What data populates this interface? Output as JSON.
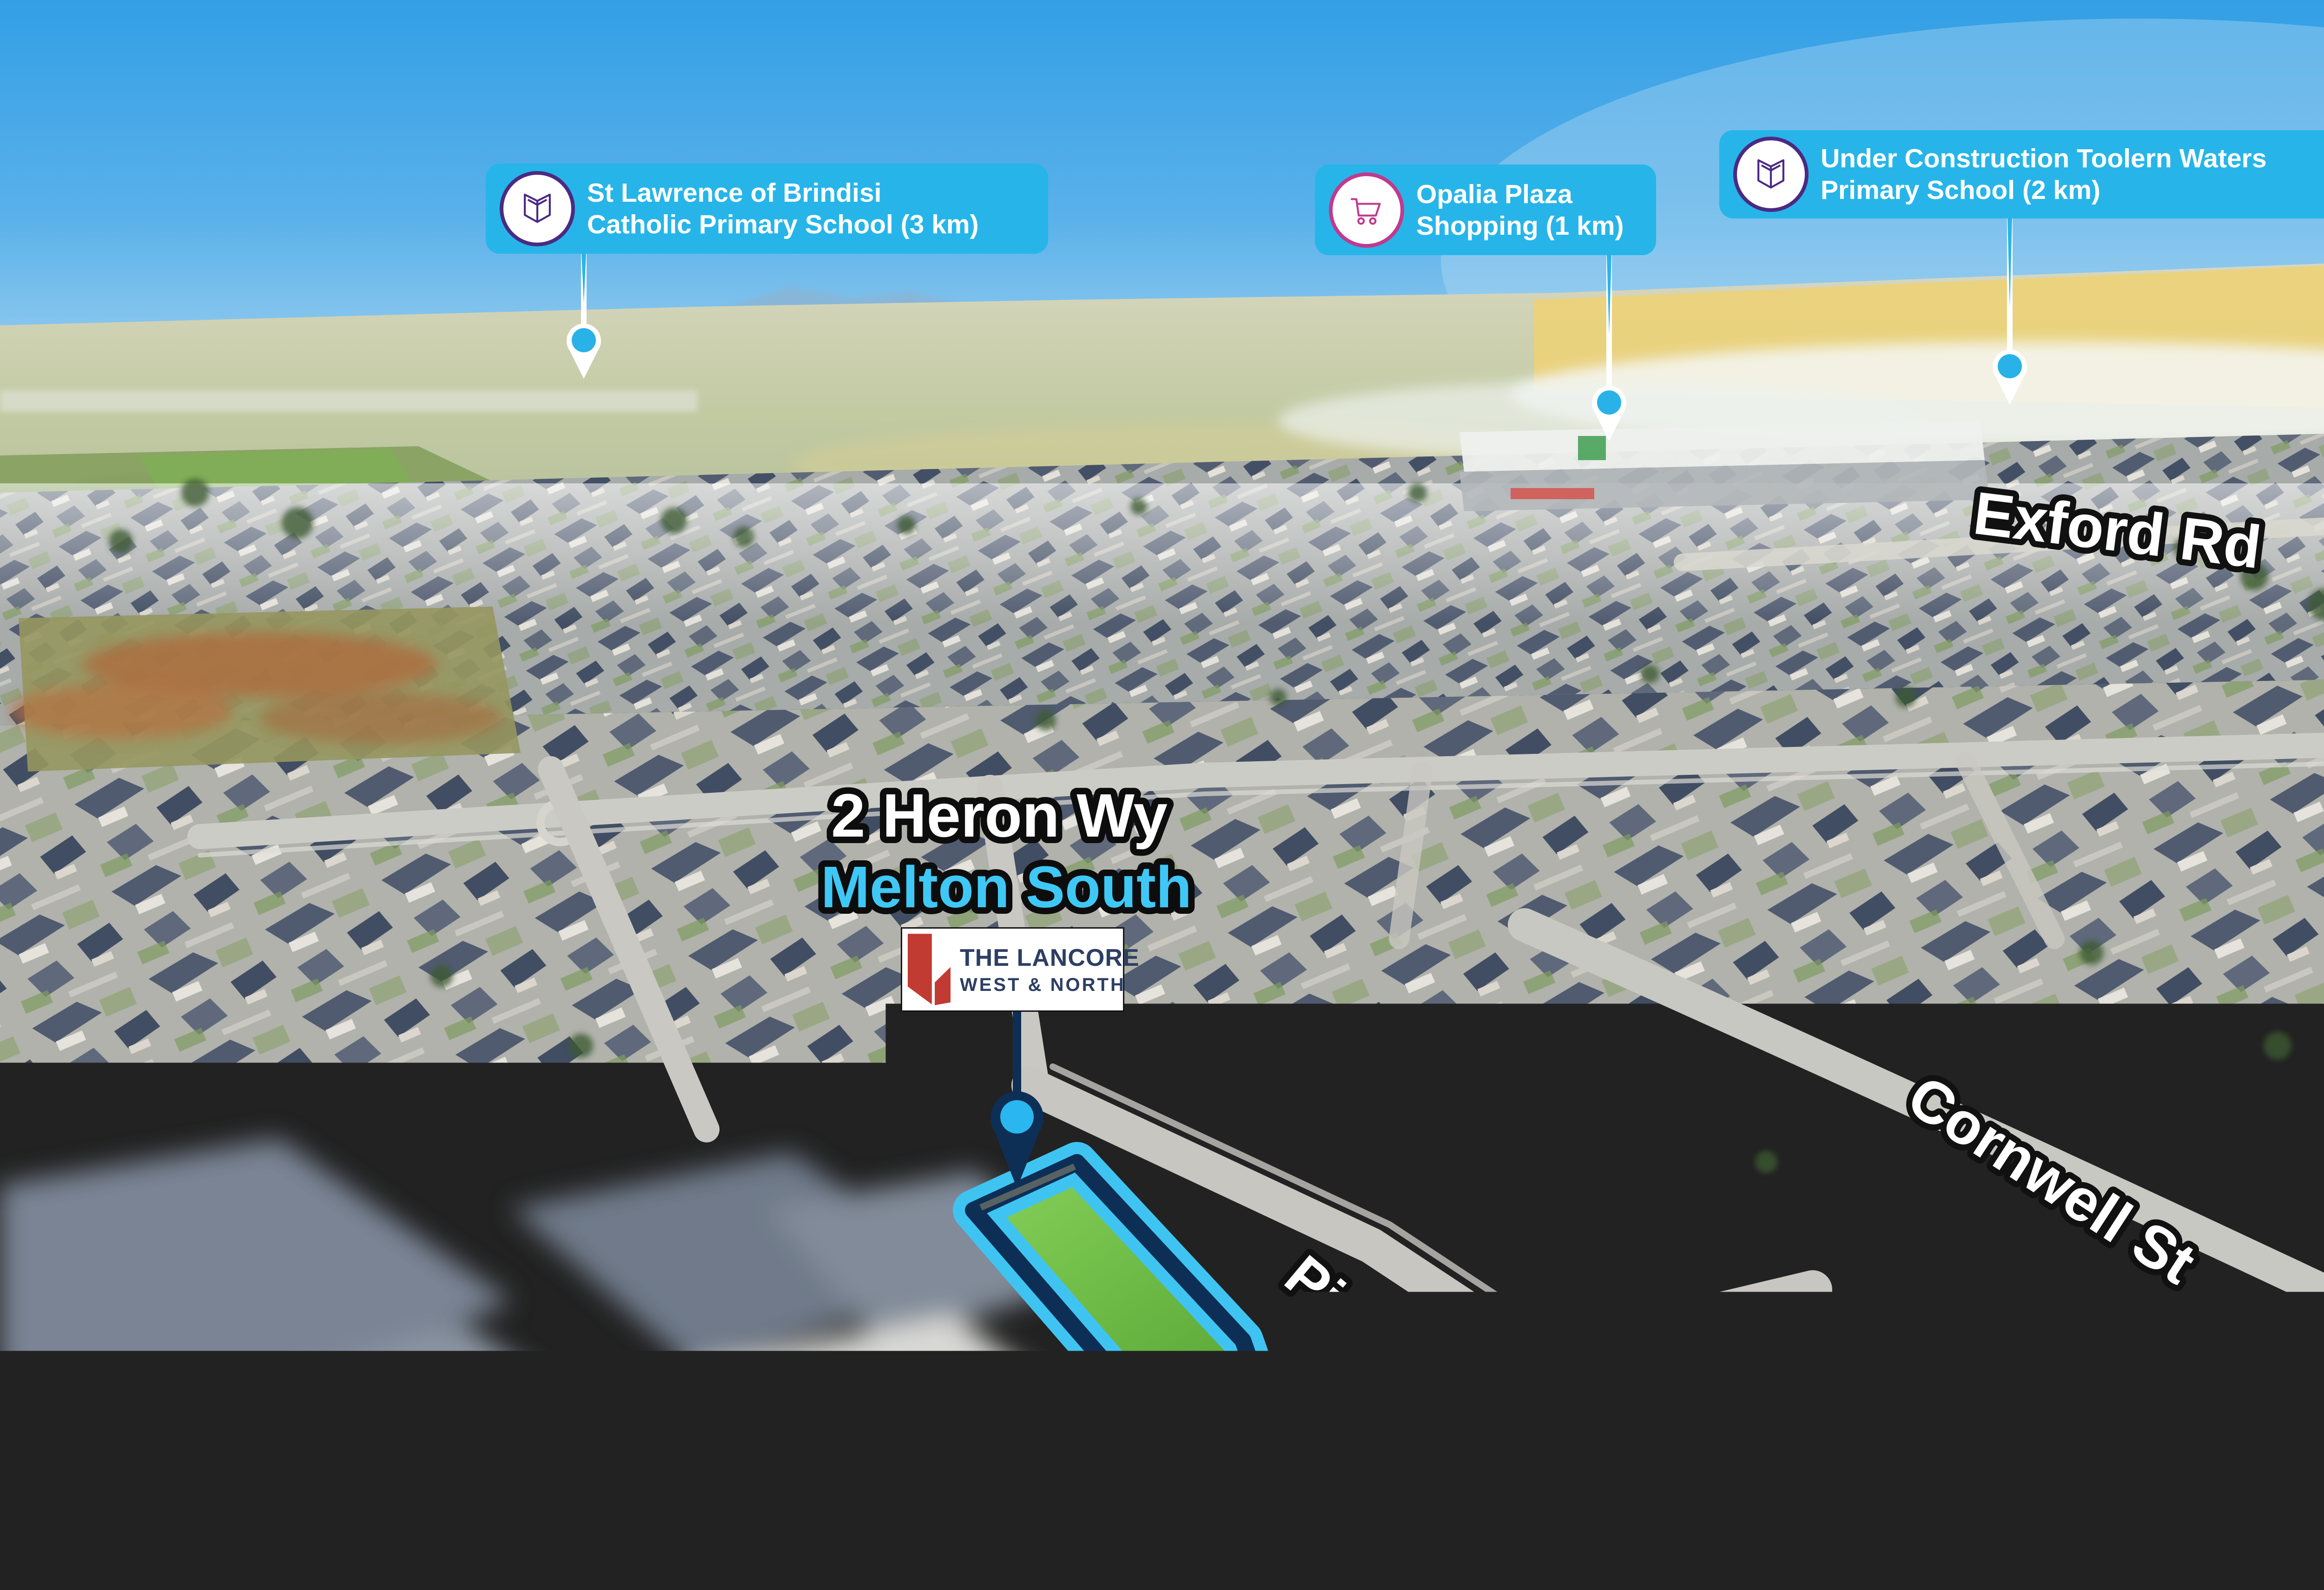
{
  "app": {
    "type": "real-estate-aerial-location-map",
    "description": "Drone aerial photo of Melton South with property and points-of-interest overlays"
  },
  "address": {
    "line1": "2 Heron Wy",
    "line2": "Melton South"
  },
  "logo": {
    "name": "THE LANCORE",
    "sub": "WEST & NORTH",
    "mark": "red-ribbon-mark"
  },
  "poi_badges": [
    {
      "icon": "open-book-icon",
      "icon_color": "#4b2a84",
      "lines": [
        "St Lawrence of Brindisi",
        "Catholic Primary School (3 km)"
      ]
    },
    {
      "icon": "shopping-cart-icon",
      "icon_color": "#c03a8e",
      "lines": [
        "Opalia Plaza",
        "Shopping (1 km)"
      ]
    },
    {
      "icon": "open-book-icon",
      "icon_color": "#4b2a84",
      "lines": [
        "Under Construction Toolern Waters",
        "Primary School (2 km)"
      ]
    }
  ],
  "road_labels": [
    {
      "text": "Exford Rd"
    },
    {
      "text": "Cornwell St"
    },
    {
      "text": "Pintail Dr"
    },
    {
      "text": "Heron Wy"
    }
  ],
  "colors": {
    "badge_bg": "#27b5e9",
    "pin_fill": "#29b2e8",
    "navy": "#0d2f56",
    "lot_outline_cyan": "#3fc4f2",
    "lot_grass": "#74c24b",
    "address_line1": "#ffffff",
    "address_line2": "#3fc8f6",
    "logo_red": "#c13b33",
    "logo_navy": "#2d3e64",
    "label_text": "#ffffff",
    "label_outline": "#111111"
  }
}
